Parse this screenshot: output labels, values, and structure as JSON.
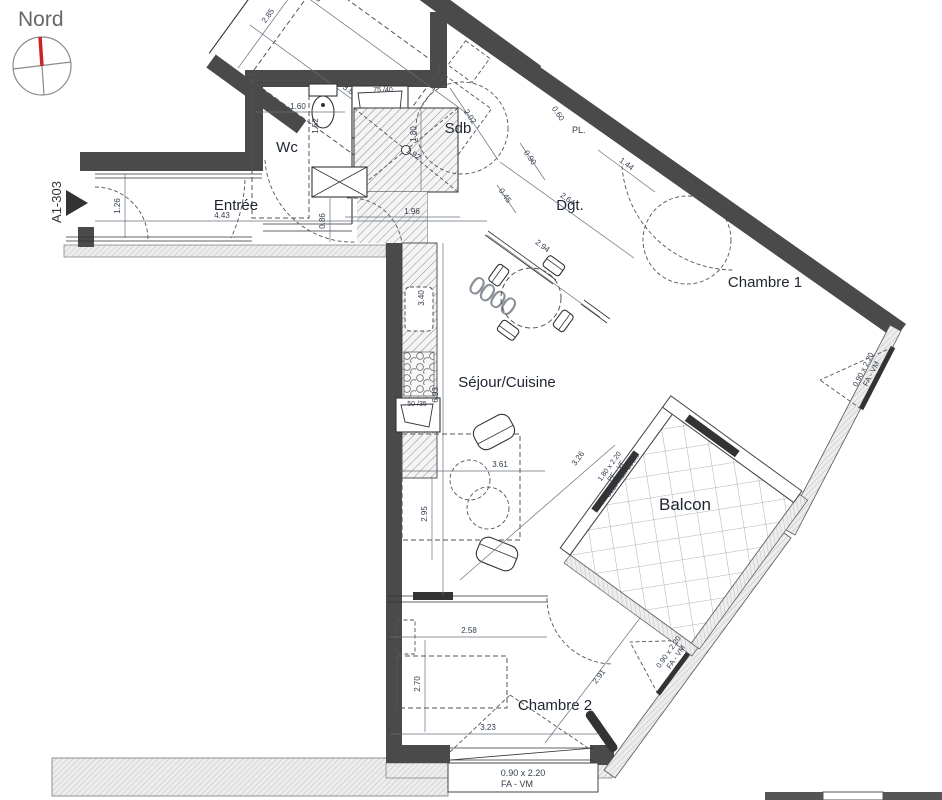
{
  "compass": {
    "label": "Nord"
  },
  "unit": {
    "label": "A1-303"
  },
  "rooms": {
    "wc": "Wc",
    "entree": "Entrée",
    "sdb": "Sdb",
    "dgt": "Dgt.",
    "ch1": "Chambre 1",
    "sejour": "Séjour/Cuisine",
    "balcon": "Balcon",
    "ch2": "Chambre 2",
    "pl": "PL."
  },
  "fixtures": {
    "vanity_a": "75 /40",
    "vanity_b": "40 /65",
    "sink": "50 /35",
    "hob": "0000"
  },
  "dims": {
    "d126": "1.26",
    "d443": "4.43",
    "d160": "1.60",
    "d152": "1.52",
    "d086": "0.86",
    "d196": "1.96",
    "d180": "1.80",
    "d192": "1.92",
    "d202": "2.02",
    "d045": "0.45",
    "d090": "0.90",
    "d264": "2.64",
    "d144": "1.44",
    "d060": "0.60",
    "d294": "2.94",
    "d693": "6.93",
    "d340": "3.40",
    "d361": "3.61",
    "d295": "2.95",
    "d326": "3.26",
    "d415": "4.15",
    "d285": "2.85",
    "d385": "3.85",
    "d258": "2.58",
    "d270": "2.70",
    "d323": "3.23",
    "d291": "2.91"
  },
  "openings": {
    "ch1_win": {
      "size": "0.90 x 2.20",
      "type": "FA - VM"
    },
    "ch2_win": {
      "size": "0.90 x 2.20",
      "type": "FA - VM"
    },
    "bottom_win": {
      "size": "0.90 x 2.20",
      "type": "FA - VM"
    },
    "balcony_door": {
      "size": "1.80 x 2.20",
      "type": "PF - VF",
      "note": "Seuil maxi 25cm"
    },
    "balcony_side": {
      "size": "0.60 x 2.20",
      "type": "PF - VR",
      "note": "Seuil maxi 25cm"
    }
  }
}
